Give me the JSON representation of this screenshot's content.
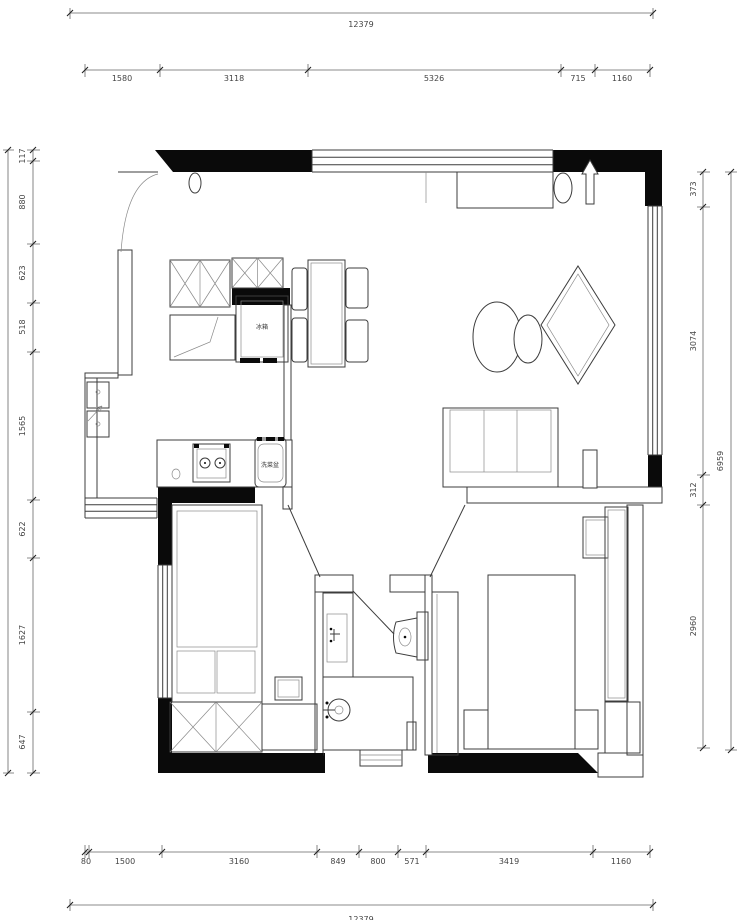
{
  "drawing": {
    "type": "floor-plan",
    "unit": "mm",
    "furniture_labels": {
      "fridge": "冰箱",
      "sink": "洗菜盆"
    },
    "dimensions": {
      "top": {
        "total": "12379",
        "chain": [
          "1580",
          "3118",
          "5326",
          "715",
          "1160"
        ]
      },
      "bottom": {
        "total": "12379",
        "chain": [
          "80",
          "1500",
          "3160",
          "849",
          "800",
          "571",
          "3419",
          "1160"
        ]
      },
      "left": {
        "chain": [
          "117",
          "880",
          "623",
          "518",
          "1565",
          "622",
          "1627",
          "647"
        ]
      },
      "right": {
        "total": "6959",
        "chain": [
          "373",
          "3074",
          "312",
          "2960"
        ]
      }
    }
  }
}
